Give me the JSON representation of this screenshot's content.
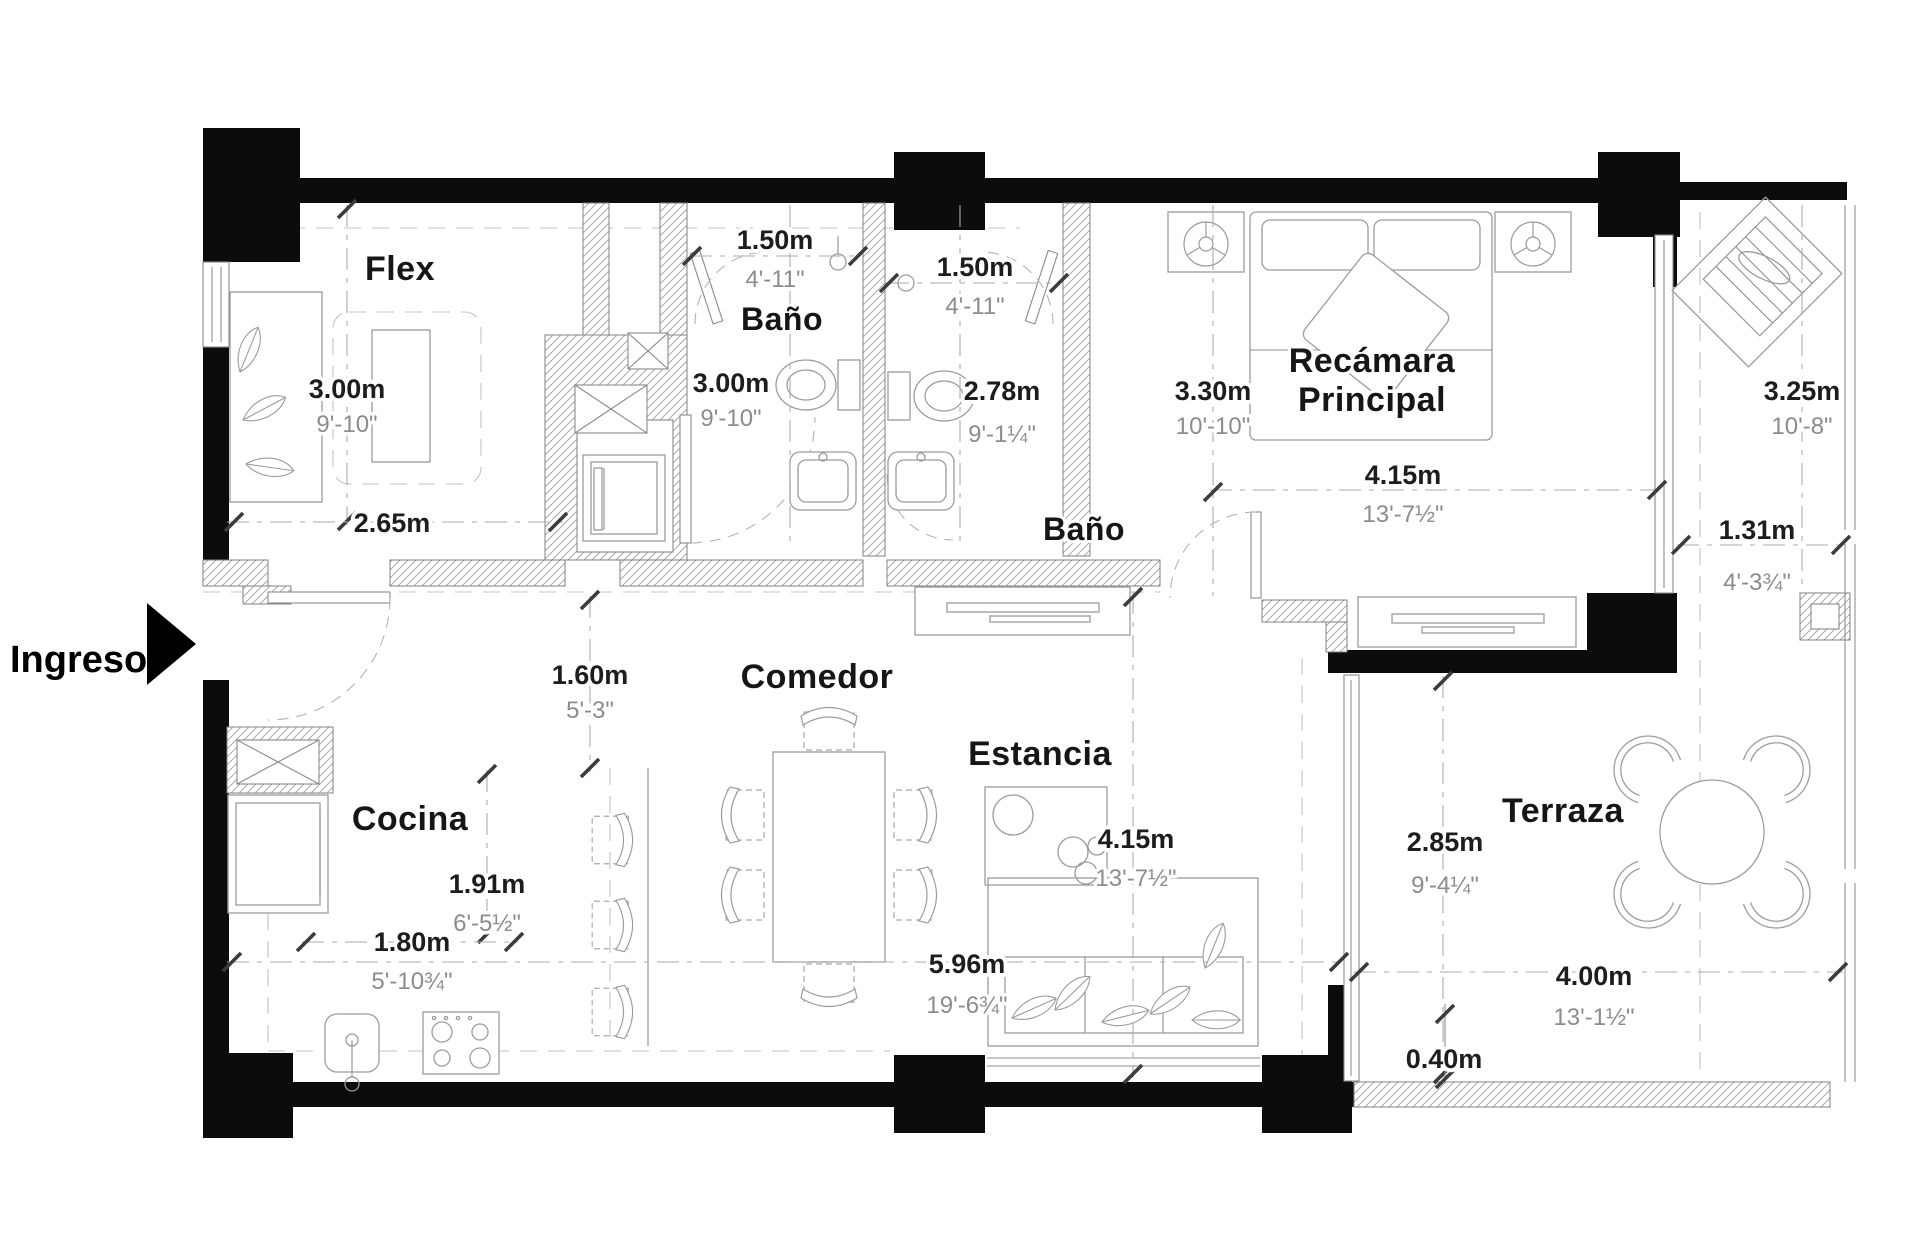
{
  "title": "Plano arquitectónico departamento",
  "entrance": {
    "label": "Ingreso"
  },
  "rooms": {
    "flex": "Flex",
    "bano1": "Baño",
    "bano2": "Baño",
    "recamara1": "Recámara",
    "recamara2": "Principal",
    "cocina": "Cocina",
    "comedor": "Comedor",
    "estancia": "Estancia",
    "terraza": "Terraza"
  },
  "dims": {
    "flex_v": {
      "m": "3.00m",
      "ft": "9'-10\""
    },
    "flex_h": {
      "m": "2.65m",
      "ft": ""
    },
    "bano1_w": {
      "m": "1.50m",
      "ft": "4'-11\""
    },
    "bano1_d": {
      "m": "3.00m",
      "ft": "9'-10\""
    },
    "bano2_w": {
      "m": "1.50m",
      "ft": "4'-11\""
    },
    "bano2_d": {
      "m": "2.78m",
      "ft": "9'-1¼\""
    },
    "rec_d": {
      "m": "3.30m",
      "ft": "10'-10\""
    },
    "rec_w": {
      "m": "4.15m",
      "ft": "13'-7½\""
    },
    "balc_d": {
      "m": "3.25m",
      "ft": "10'-8\""
    },
    "balc_w": {
      "m": "1.31m",
      "ft": "4'-3¾\""
    },
    "hall": {
      "m": "1.60m",
      "ft": "5'-3\""
    },
    "coc_d": {
      "m": "1.91m",
      "ft": "6'-5½\""
    },
    "coc_w": {
      "m": "1.80m",
      "ft": "5'-10¾\""
    },
    "est_d": {
      "m": "4.15m",
      "ft": "13'-7½\""
    },
    "est_w": {
      "m": "5.96m",
      "ft": "19'-6¾\""
    },
    "ter_d": {
      "m": "2.85m",
      "ft": "9'-4¼\""
    },
    "ter_w": {
      "m": "4.00m",
      "ft": "13'-1½\""
    },
    "edge": {
      "m": "0.40m",
      "ft": ""
    }
  },
  "colors": {
    "wall": "#0c0c0c",
    "dim_meters": "#1d1d1d",
    "dim_feet": "#8c8c8c",
    "linework": "#9c9c9c"
  }
}
